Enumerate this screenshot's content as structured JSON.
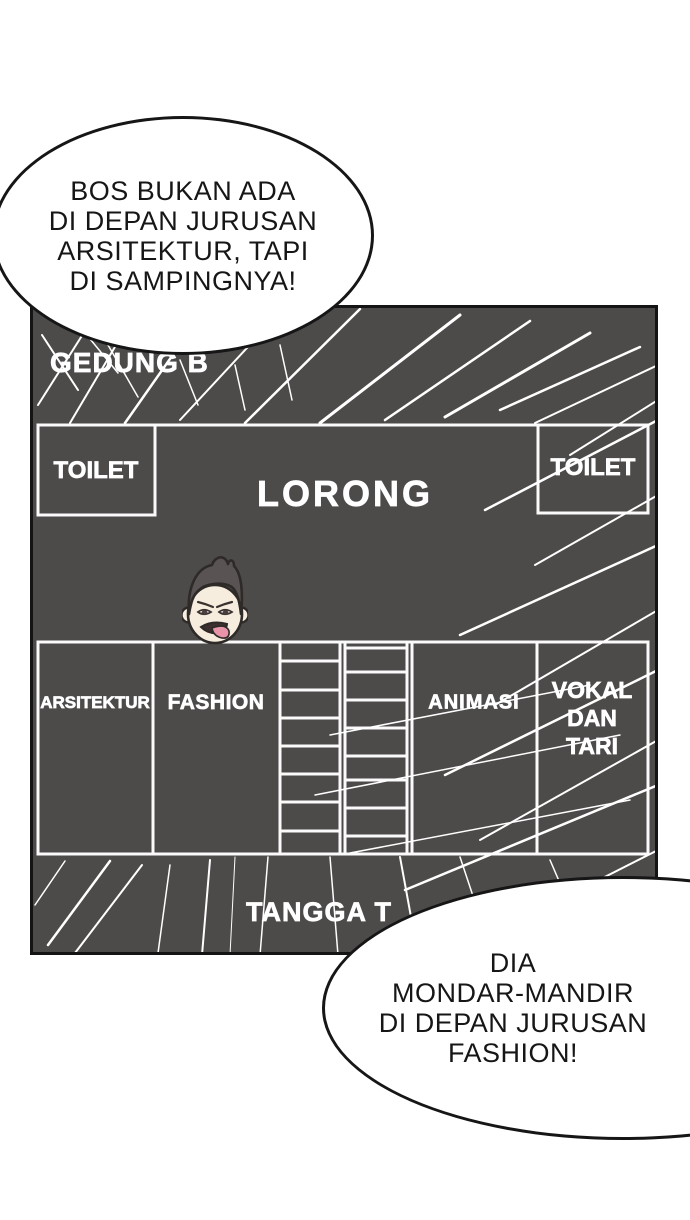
{
  "page": {
    "background_color": "#ffffff",
    "panel_bg_color": "#4d4a4a",
    "line_color": "#ffffff",
    "outline_color": "#161616"
  },
  "speech_bubbles": {
    "top": {
      "text": "BOS BUKAN ADA\nDI DEPAN JURUSAN\nARSITEKTUR, TAPI\nDI SAMPINGNYA!"
    },
    "bottom": {
      "text": "DIA\nMONDAR-MANDIR\nDI DEPAN JURUSAN\nFASHION!"
    }
  },
  "map": {
    "building_label": "GEDUNG B",
    "rooms": {
      "toilet_left": "TOILET",
      "corridor": "LORONG",
      "toilet_right": "TOILET",
      "arsitektur": "ARSITEKTUR",
      "fashion": "FASHION",
      "animasi": "ANIMASI",
      "vokal_dan_tari": "VOKAL DAN TARI",
      "stairs_label": "TANGGA T"
    },
    "label_text_color": "#ffffff"
  },
  "character": {
    "description": "annoyed-face-with-tongue-out",
    "skin_color": "#f7eddf",
    "hair_color": "#595453",
    "tongue_color": "#e893a8"
  }
}
